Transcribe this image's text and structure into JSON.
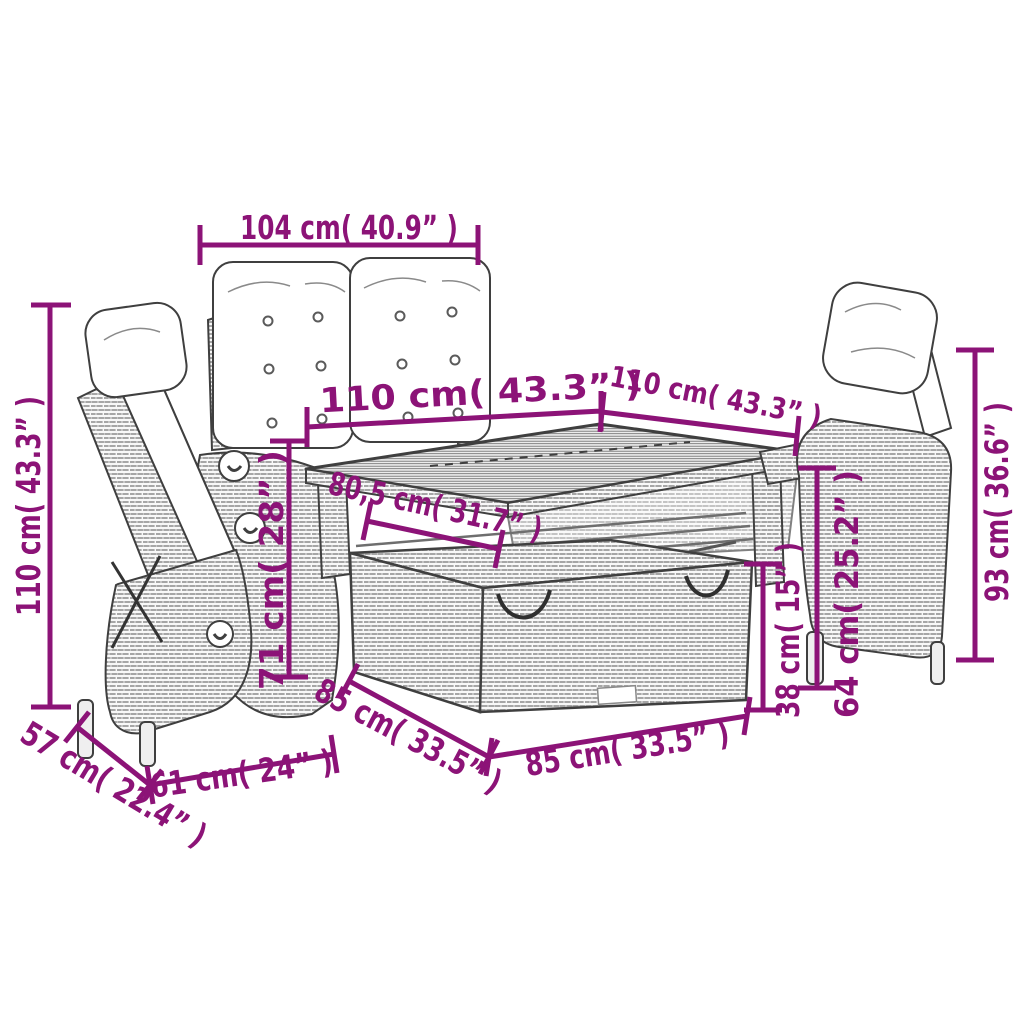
{
  "diagram": {
    "background_color": "#ffffff",
    "dimension_color": "#8C1377",
    "outline_color": "#3f3f3f",
    "wicker_line_color": "#9b9b9b",
    "cushion_color": "#ffffff",
    "dimensions": {
      "back_chairs_width": "104 cm( 40.9” )",
      "table_length_left": "110 cm( 43.3” )",
      "table_length_right": "110 cm( 43.3” )",
      "left_chair_height": "110 cm( 43.3” )",
      "table_depth": "80,5 cm( 31.7” )",
      "table_height": "71 cm( 28” )",
      "left_chair_depth": "57 cm( 22.4” )",
      "left_chair_width": "61 cm( 24” )",
      "bench_depth": "85 cm( 33.5” )",
      "bench_width": "85 cm( 33.5” )",
      "bench_height": "38 cm( 15” )",
      "right_chair_arm_height": "64 cm( 25.2” )",
      "right_chair_height": "93 cm( 36.6” )"
    }
  }
}
